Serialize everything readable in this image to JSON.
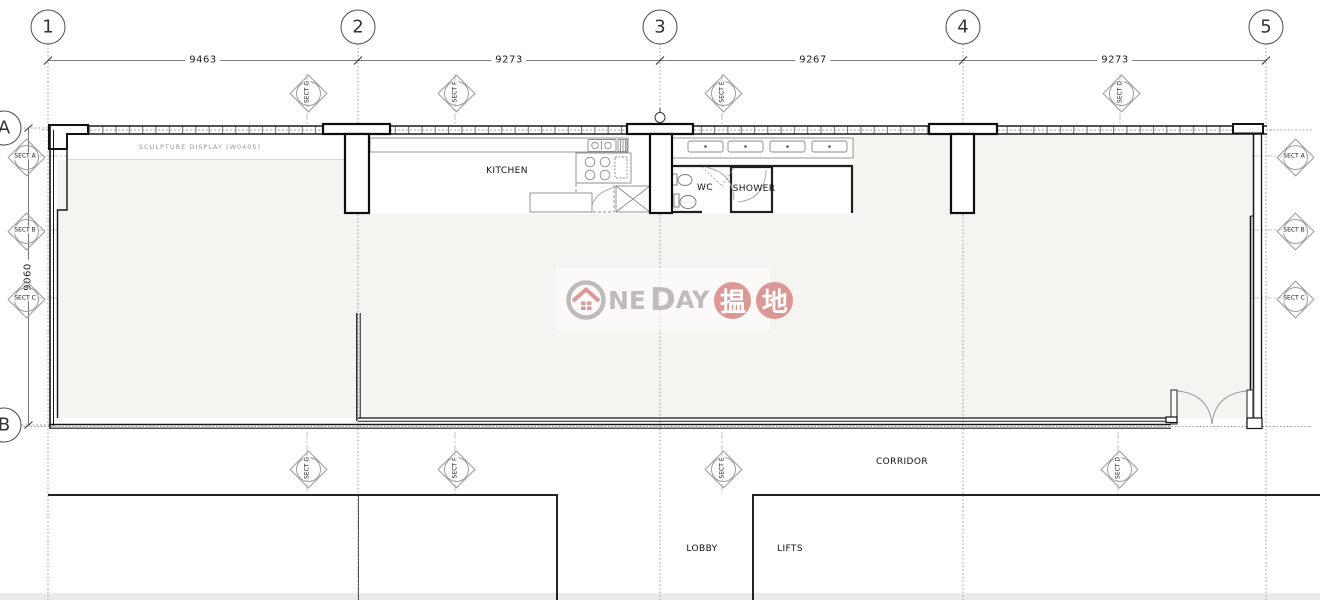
{
  "drawing": {
    "type": "floor-plan",
    "palette": {
      "wall_line": "#1a1a1a",
      "interior_fill": "#f5f4f1",
      "watermark_gray": "#b7b3b2",
      "watermark_red": "#d88b88"
    }
  },
  "grid": {
    "columns": [
      {
        "label": "1"
      },
      {
        "label": "2"
      },
      {
        "label": "3"
      },
      {
        "label": "4"
      },
      {
        "label": "5"
      }
    ],
    "rows": [
      {
        "label": "A"
      },
      {
        "label": "B"
      }
    ]
  },
  "dimensions": {
    "top": [
      {
        "value": "9463"
      },
      {
        "value": "9273"
      },
      {
        "value": "9267"
      },
      {
        "value": "9273"
      }
    ],
    "left": {
      "value": "9060"
    }
  },
  "rooms": {
    "kitchen": "KITCHEN",
    "wc": "WC",
    "shower": "SHOWER",
    "corridor": "CORRIDOR",
    "lobby": "LOBBY",
    "lifts": "LIFTS"
  },
  "annotations": {
    "sculpture_display": "SCULPTURE DISPLAY (W0405)"
  },
  "section_markers": {
    "top": [
      {
        "label": "SECT G"
      },
      {
        "label": "SECT F"
      },
      {
        "label": "SECT E"
      },
      {
        "label": "SECT D"
      }
    ],
    "bottom": [
      {
        "label": "SECT G"
      },
      {
        "label": "SECT F"
      },
      {
        "label": "SECT E"
      },
      {
        "label": "SECT D"
      }
    ],
    "left": [
      {
        "label": "SECT A"
      },
      {
        "label": "SECT B"
      },
      {
        "label": "SECT C"
      }
    ],
    "right": [
      {
        "label": "SECT A"
      },
      {
        "label": "SECT B"
      },
      {
        "label": "SECT C"
      }
    ]
  },
  "watermark": {
    "brand_prefix": "NE",
    "day_d": "D",
    "day_ay": "AY",
    "char_1": "揾",
    "char_2": "地"
  }
}
